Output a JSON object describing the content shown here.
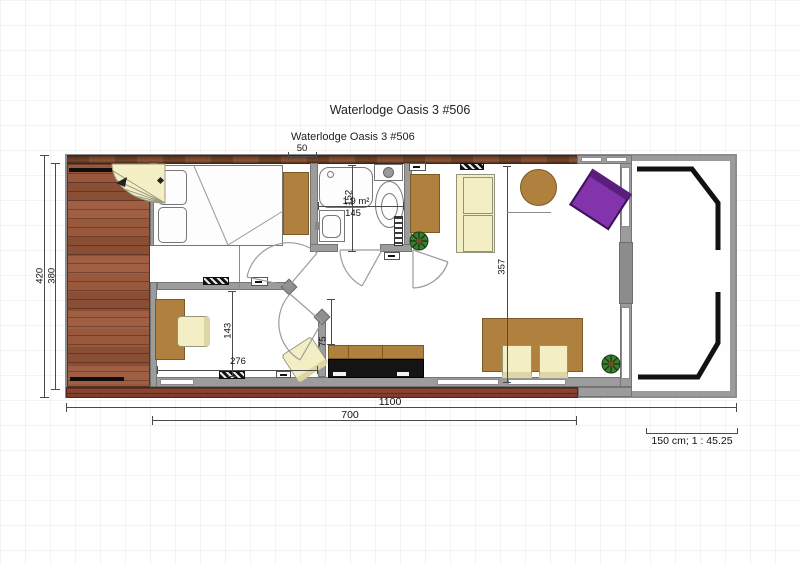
{
  "title": "Waterlodge Oasis 3 #506",
  "plan_label": "Waterlodge Oasis 3 #506",
  "scale_bar": {
    "label": "150 cm; 1 : 45.25"
  },
  "dimensions": {
    "d50": "50",
    "d420": "420",
    "d380": "380",
    "d152": "152",
    "bath_area": "1,9 m²",
    "d145": "145",
    "d357": "357",
    "d143": "143",
    "d276": "276",
    "d75": "75",
    "d1100": "1100",
    "d700": "700"
  },
  "colors": {
    "deck_wood": "#8a5138",
    "wall_gray": "#9c9c9c",
    "furniture_brown": "#b0803e",
    "seat_cream": "#f4eec5",
    "armchair_purple": "#8333ab",
    "plant_green": "#3f7d35",
    "railing_black": "#111111"
  }
}
